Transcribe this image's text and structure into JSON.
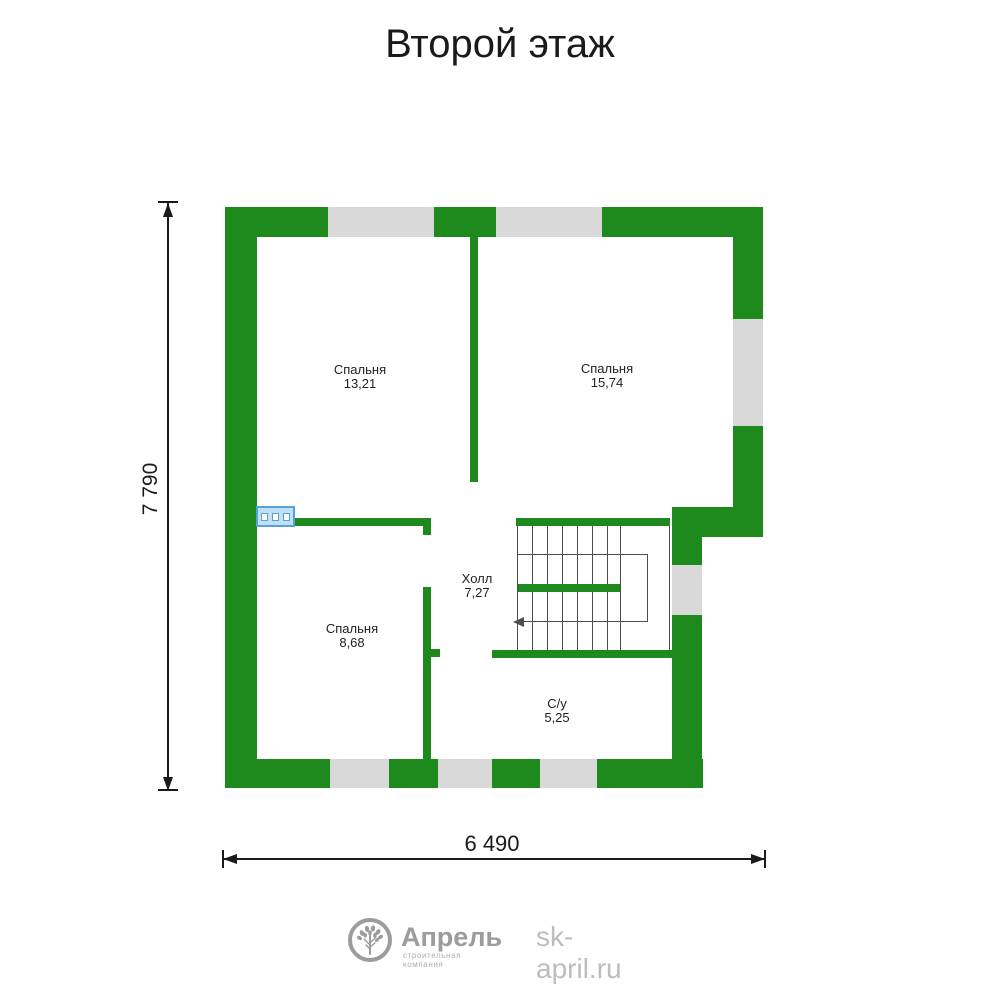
{
  "title": "Второй этаж",
  "rooms": [
    {
      "name": "Спальня",
      "area": "13,21"
    },
    {
      "name": "Спальня",
      "area": "15,74"
    },
    {
      "name": "Спальня",
      "area": "8,68"
    },
    {
      "name": "Холл",
      "area": "7,27"
    },
    {
      "name": "С/у",
      "area": "5,25"
    }
  ],
  "dimensions": {
    "vertical": "7 790",
    "horizontal": "6 490"
  },
  "footer": {
    "brand": "Апрель",
    "tagline": "строительная компания",
    "website": "sk-april.ru"
  },
  "colors": {
    "wall_green": "#1e8a1d",
    "window_gray": "#d9d9d9",
    "stair_line": "#4d4d4d",
    "ink": "#1a1a1a",
    "label_ink": "#222222",
    "radiator_fill": "#bfe0f5",
    "radiator_border": "#57a0d8",
    "logo_gray": "#9c9c9c",
    "tagline_gray": "#aeaeae",
    "site_gray": "#bdbdbd"
  }
}
